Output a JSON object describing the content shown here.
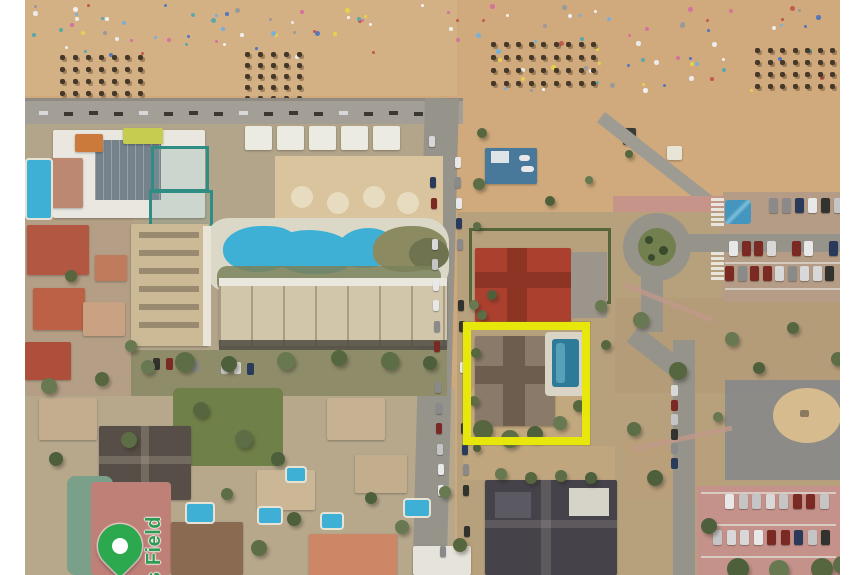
{
  "map": {
    "kind": "satellite-aerial-view",
    "label": {
      "text": "ts Field",
      "color": "#2f9b52"
    },
    "marker": {
      "name": "green-map-pin",
      "color": "#2ca84f",
      "dot_color": "#ffffff"
    },
    "highlight": {
      "shape": "rectangle",
      "color": "#e8e70c"
    },
    "palette": {
      "margin": "#ffffff",
      "beach_sand": "#d4b184",
      "dune_sand": "#cfa97b",
      "urban_ground": "#b3a58a",
      "road": "#96938b",
      "promenade": "#a39f96",
      "pool_water": "#3eb0d5",
      "vegetation": "#5d6d45",
      "red_roof": "#ac402e",
      "dark_roof": "#454249",
      "pink_pavement": "#c4928a"
    }
  }
}
